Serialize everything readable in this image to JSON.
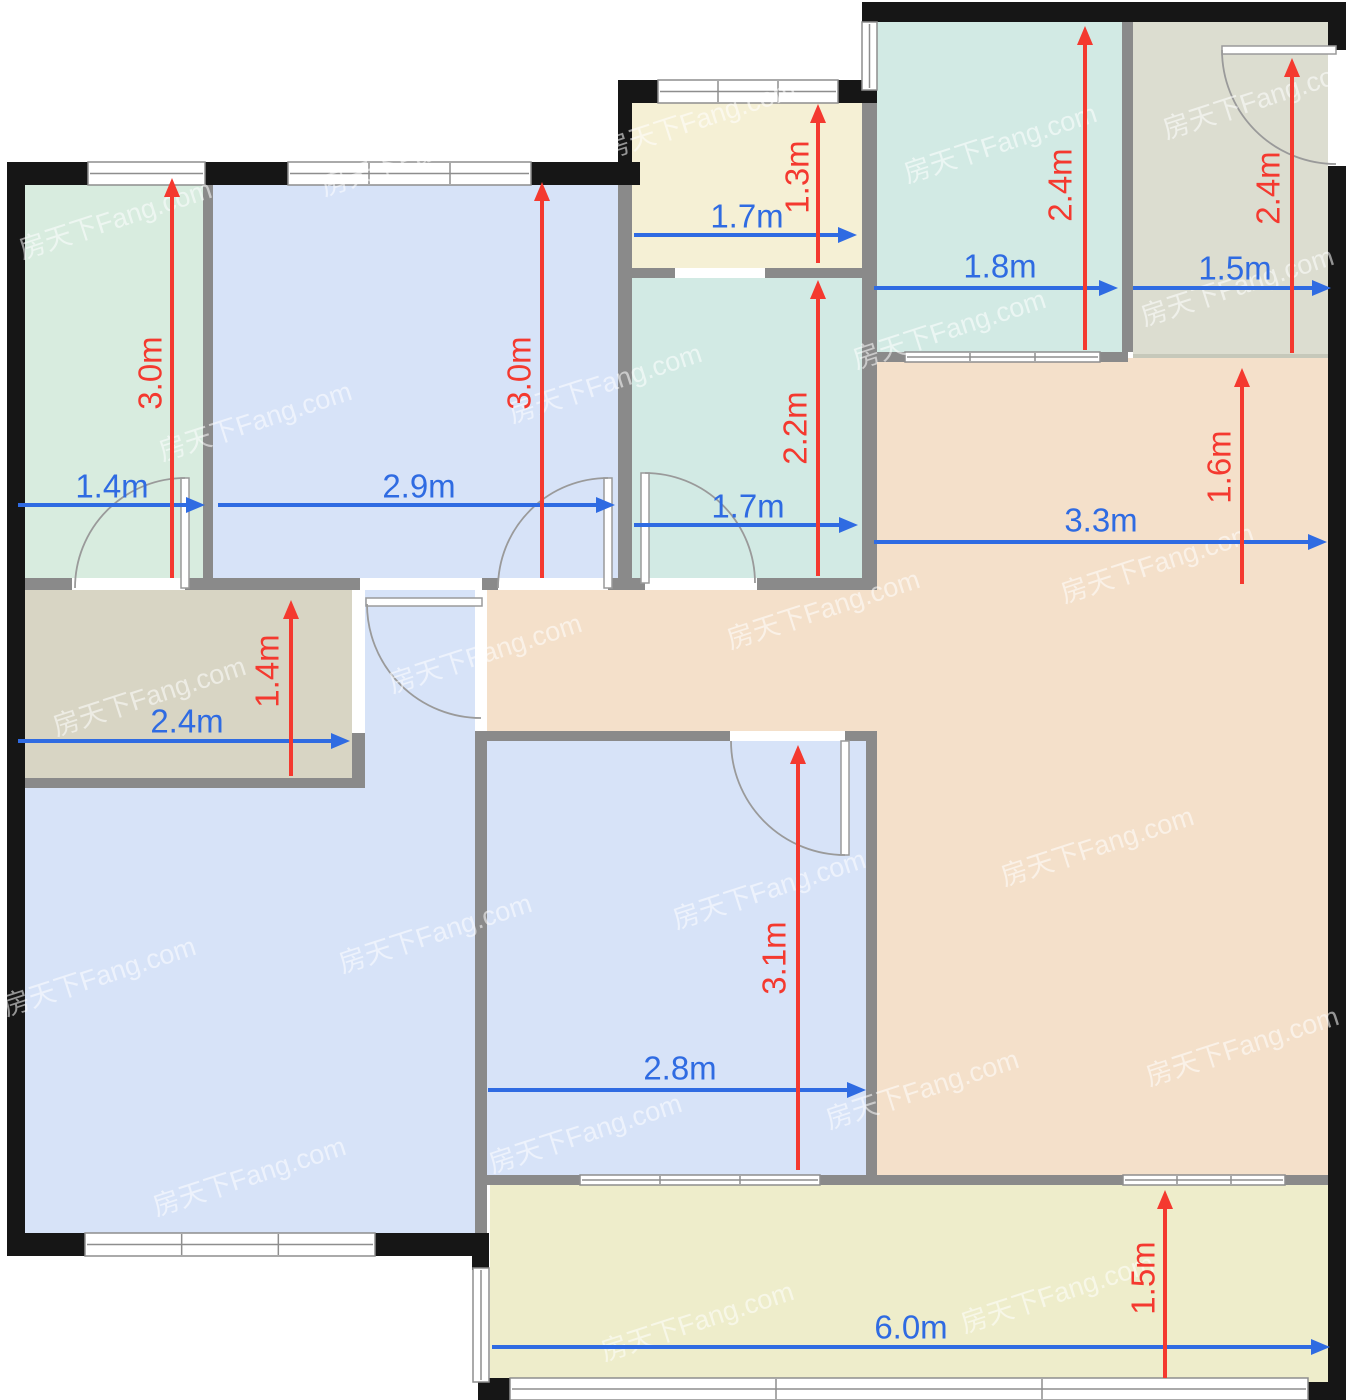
{
  "plan": {
    "canvas": {
      "w": 1346,
      "h": 1400
    },
    "palette": {
      "wall_black": "#161616",
      "wall_gray": "#8a8a8a",
      "window_fill": "#ffffff",
      "window_line": "#8e8e8e",
      "door_stroke": "#9a9a9a",
      "edge_soft": "#c6c8ba",
      "dim_blue": "#2f6be2",
      "dim_red": "#f4392f",
      "watermark": "rgba(255,255,255,0.55)"
    },
    "watermark_text": "房天下Fang.com",
    "rooms": [
      {
        "name": "bedroom-northwest",
        "fill": "#d8ecdf",
        "x": 25,
        "y": 175,
        "w": 178,
        "h": 403
      },
      {
        "name": "bedroom-north",
        "fill": "#d7e3f8",
        "x": 213,
        "y": 175,
        "w": 405,
        "h": 403
      },
      {
        "name": "closet-north",
        "fill": "#f5f0d5",
        "x": 632,
        "y": 100,
        "w": 230,
        "h": 168
      },
      {
        "name": "bathroom-middle",
        "fill": "#d2eae4",
        "x": 632,
        "y": 278,
        "w": 230,
        "h": 300
      },
      {
        "name": "bathroom-northeast",
        "fill": "#d2eae4",
        "x": 877,
        "y": 20,
        "w": 245,
        "h": 332
      },
      {
        "name": "kitchen-northeast",
        "fill": "#dcddd0",
        "x": 1133,
        "y": 20,
        "w": 195,
        "h": 338
      },
      {
        "name": "living-dining-east",
        "fill": "#f4e0ca",
        "x": 872,
        "y": 358,
        "w": 456,
        "h": 817
      },
      {
        "name": "corridor",
        "fill": "#f4e0ca",
        "x": 487,
        "y": 590,
        "w": 390,
        "h": 141
      },
      {
        "name": "storage-west",
        "fill": "#d8d5c4",
        "x": 25,
        "y": 590,
        "w": 327,
        "h": 188
      },
      {
        "name": "foyer",
        "fill": "#d7e3f8",
        "x": 365,
        "y": 590,
        "w": 110,
        "h": 658
      },
      {
        "name": "living-room-southwest",
        "fill": "#d7e3f8",
        "x": 25,
        "y": 788,
        "w": 450,
        "h": 460
      },
      {
        "name": "bedroom-south",
        "fill": "#d7e3f8",
        "x": 487,
        "y": 741,
        "w": 379,
        "h": 434
      },
      {
        "name": "balcony-south",
        "fill": "#eeedcb",
        "x": 490,
        "y": 1185,
        "w": 838,
        "h": 197
      }
    ],
    "soft_edges": [
      [
        1133,
        354,
        195,
        4
      ]
    ],
    "walls_gray": [
      [
        203,
        185,
        10,
        393
      ],
      [
        25,
        578,
        47,
        12
      ],
      [
        185,
        578,
        175,
        12
      ],
      [
        482,
        578,
        16,
        12
      ],
      [
        608,
        578,
        37,
        12
      ],
      [
        757,
        578,
        120,
        12
      ],
      [
        618,
        178,
        14,
        400
      ],
      [
        632,
        268,
        43,
        10
      ],
      [
        765,
        268,
        97,
        10
      ],
      [
        862,
        103,
        15,
        487
      ],
      [
        1122,
        20,
        11,
        332
      ],
      [
        862,
        352,
        43,
        10
      ],
      [
        1100,
        352,
        28,
        10
      ],
      [
        7,
        778,
        358,
        10
      ],
      [
        352,
        733,
        13,
        55
      ],
      [
        475,
        731,
        12,
        517
      ],
      [
        487,
        731,
        243,
        10
      ],
      [
        845,
        731,
        32,
        10
      ],
      [
        866,
        741,
        11,
        434
      ],
      [
        487,
        1175,
        93,
        10
      ],
      [
        820,
        1175,
        57,
        10
      ],
      [
        877,
        1175,
        246,
        10
      ],
      [
        1285,
        1175,
        43,
        10
      ]
    ],
    "walls_black": [
      [
        7,
        162,
        81,
        23
      ],
      [
        205,
        162,
        83,
        23
      ],
      [
        531,
        162,
        109,
        23
      ],
      [
        7,
        162,
        18,
        1094
      ],
      [
        7,
        1233,
        78,
        23
      ],
      [
        375,
        1233,
        114,
        23
      ],
      [
        618,
        80,
        40,
        23
      ],
      [
        838,
        80,
        39,
        23
      ],
      [
        618,
        80,
        14,
        98
      ],
      [
        862,
        2,
        484,
        20
      ],
      [
        1328,
        2,
        18,
        48
      ],
      [
        1328,
        166,
        18,
        1216
      ],
      [
        1308,
        1382,
        38,
        18
      ],
      [
        478,
        1378,
        32,
        22
      ],
      [
        472,
        1233,
        17,
        37
      ]
    ],
    "windows": [
      {
        "x": 88,
        "y": 162,
        "w": 117,
        "h": 23,
        "o": "h"
      },
      {
        "x": 288,
        "y": 162,
        "w": 243,
        "h": 23,
        "o": "h"
      },
      {
        "x": 658,
        "y": 80,
        "w": 180,
        "h": 23,
        "o": "h"
      },
      {
        "x": 862,
        "y": 22,
        "w": 15,
        "h": 68,
        "o": "v"
      },
      {
        "x": 905,
        "y": 352,
        "w": 195,
        "h": 10,
        "o": "h"
      },
      {
        "x": 580,
        "y": 1175,
        "w": 240,
        "h": 10,
        "o": "h"
      },
      {
        "x": 1123,
        "y": 1175,
        "w": 162,
        "h": 10,
        "o": "h"
      },
      {
        "x": 85,
        "y": 1233,
        "w": 290,
        "h": 23,
        "o": "h"
      },
      {
        "x": 473,
        "y": 1268,
        "w": 16,
        "h": 114,
        "o": "v"
      },
      {
        "x": 510,
        "y": 1378,
        "w": 798,
        "h": 22,
        "o": "h"
      }
    ],
    "door_openings": [
      [
        72,
        578,
        113,
        12
      ],
      [
        360,
        578,
        122,
        12
      ],
      [
        498,
        578,
        110,
        12
      ],
      [
        645,
        578,
        112,
        12
      ],
      [
        675,
        268,
        90,
        10
      ],
      [
        730,
        731,
        115,
        10
      ],
      [
        1328,
        50,
        18,
        116
      ],
      [
        475,
        590,
        12,
        141
      ],
      [
        352,
        590,
        13,
        143
      ]
    ],
    "door_leaves": [
      [
        181,
        478,
        8,
        110
      ],
      [
        604,
        478,
        8,
        110
      ],
      [
        641,
        473,
        8,
        110
      ],
      [
        366,
        598,
        116,
        8
      ],
      [
        841,
        741,
        8,
        114
      ],
      [
        1222,
        46,
        114,
        8
      ]
    ],
    "door_arcs": [
      "M185,478 A110,110 0 0 0 75,588",
      "M608,478 A110,110 0 0 0 498,588",
      "M645,473 A110,110 0 0 1 755,583",
      "M367,604 A114,114 0 0 0 481,718",
      "M845,855 A114,114 0 0 1 731,741",
      "M1222,50 A114,114 0 0 0 1336,164"
    ],
    "watermarks": [
      [
        118,
        228
      ],
      [
        420,
        165
      ],
      [
        702,
        128
      ],
      [
        1003,
        152
      ],
      [
        1262,
        108
      ],
      [
        258,
        430
      ],
      [
        608,
        392
      ],
      [
        952,
        338
      ],
      [
        1240,
        295
      ],
      [
        152,
        705
      ],
      [
        488,
        662
      ],
      [
        826,
        618
      ],
      [
        1160,
        572
      ],
      [
        102,
        985
      ],
      [
        438,
        942
      ],
      [
        772,
        898
      ],
      [
        1100,
        855
      ],
      [
        252,
        1185
      ],
      [
        588,
        1142
      ],
      [
        925,
        1098
      ],
      [
        1245,
        1055
      ],
      [
        700,
        1330
      ],
      [
        1060,
        1302
      ]
    ]
  },
  "dimensions": {
    "horizontal": [
      {
        "label": "1.4m",
        "x1": 18,
        "x2": 205,
        "y": 505,
        "lx": 112,
        "ly": 486
      },
      {
        "label": "2.9m",
        "x1": 218,
        "x2": 615,
        "y": 505,
        "lx": 419,
        "ly": 486
      },
      {
        "label": "1.7m",
        "x1": 634,
        "x2": 857,
        "y": 235,
        "lx": 747,
        "ly": 216
      },
      {
        "label": "1.7m",
        "x1": 634,
        "x2": 858,
        "y": 525,
        "lx": 748,
        "ly": 506
      },
      {
        "label": "1.8m",
        "x1": 874,
        "x2": 1118,
        "y": 288,
        "lx": 1000,
        "ly": 266
      },
      {
        "label": "1.5m",
        "x1": 1133,
        "x2": 1331,
        "y": 288,
        "lx": 1235,
        "ly": 268
      },
      {
        "label": "3.3m",
        "x1": 874,
        "x2": 1327,
        "y": 542,
        "lx": 1101,
        "ly": 520
      },
      {
        "label": "2.4m",
        "x1": 18,
        "x2": 350,
        "y": 741,
        "lx": 187,
        "ly": 721
      },
      {
        "label": "2.8m",
        "x1": 488,
        "x2": 866,
        "y": 1090,
        "lx": 680,
        "ly": 1068
      },
      {
        "label": "6.0m",
        "x1": 492,
        "x2": 1330,
        "y": 1347,
        "lx": 911,
        "ly": 1327
      }
    ],
    "vertical": [
      {
        "label": "3.0m",
        "x": 172,
        "y1": 178,
        "y2": 578,
        "lx": 150,
        "ly": 373
      },
      {
        "label": "3.0m",
        "x": 542,
        "y1": 182,
        "y2": 578,
        "lx": 519,
        "ly": 373
      },
      {
        "label": "1.3m",
        "x": 818,
        "y1": 104,
        "y2": 263,
        "lx": 797,
        "ly": 177
      },
      {
        "label": "2.2m",
        "x": 818,
        "y1": 280,
        "y2": 576,
        "lx": 795,
        "ly": 428
      },
      {
        "label": "2.4m",
        "x": 1085,
        "y1": 26,
        "y2": 350,
        "lx": 1060,
        "ly": 185
      },
      {
        "label": "2.4m",
        "x": 1292,
        "y1": 58,
        "y2": 353,
        "lx": 1268,
        "ly": 188
      },
      {
        "label": "1.6m",
        "x": 1242,
        "y1": 368,
        "y2": 584,
        "lx": 1219,
        "ly": 467
      },
      {
        "label": "1.4m",
        "x": 291,
        "y1": 600,
        "y2": 776,
        "lx": 267,
        "ly": 671
      },
      {
        "label": "3.1m",
        "x": 798,
        "y1": 745,
        "y2": 1170,
        "lx": 774,
        "ly": 958
      },
      {
        "label": "1.5m",
        "x": 1165,
        "y1": 1190,
        "y2": 1378,
        "lx": 1143,
        "ly": 1278
      }
    ]
  }
}
